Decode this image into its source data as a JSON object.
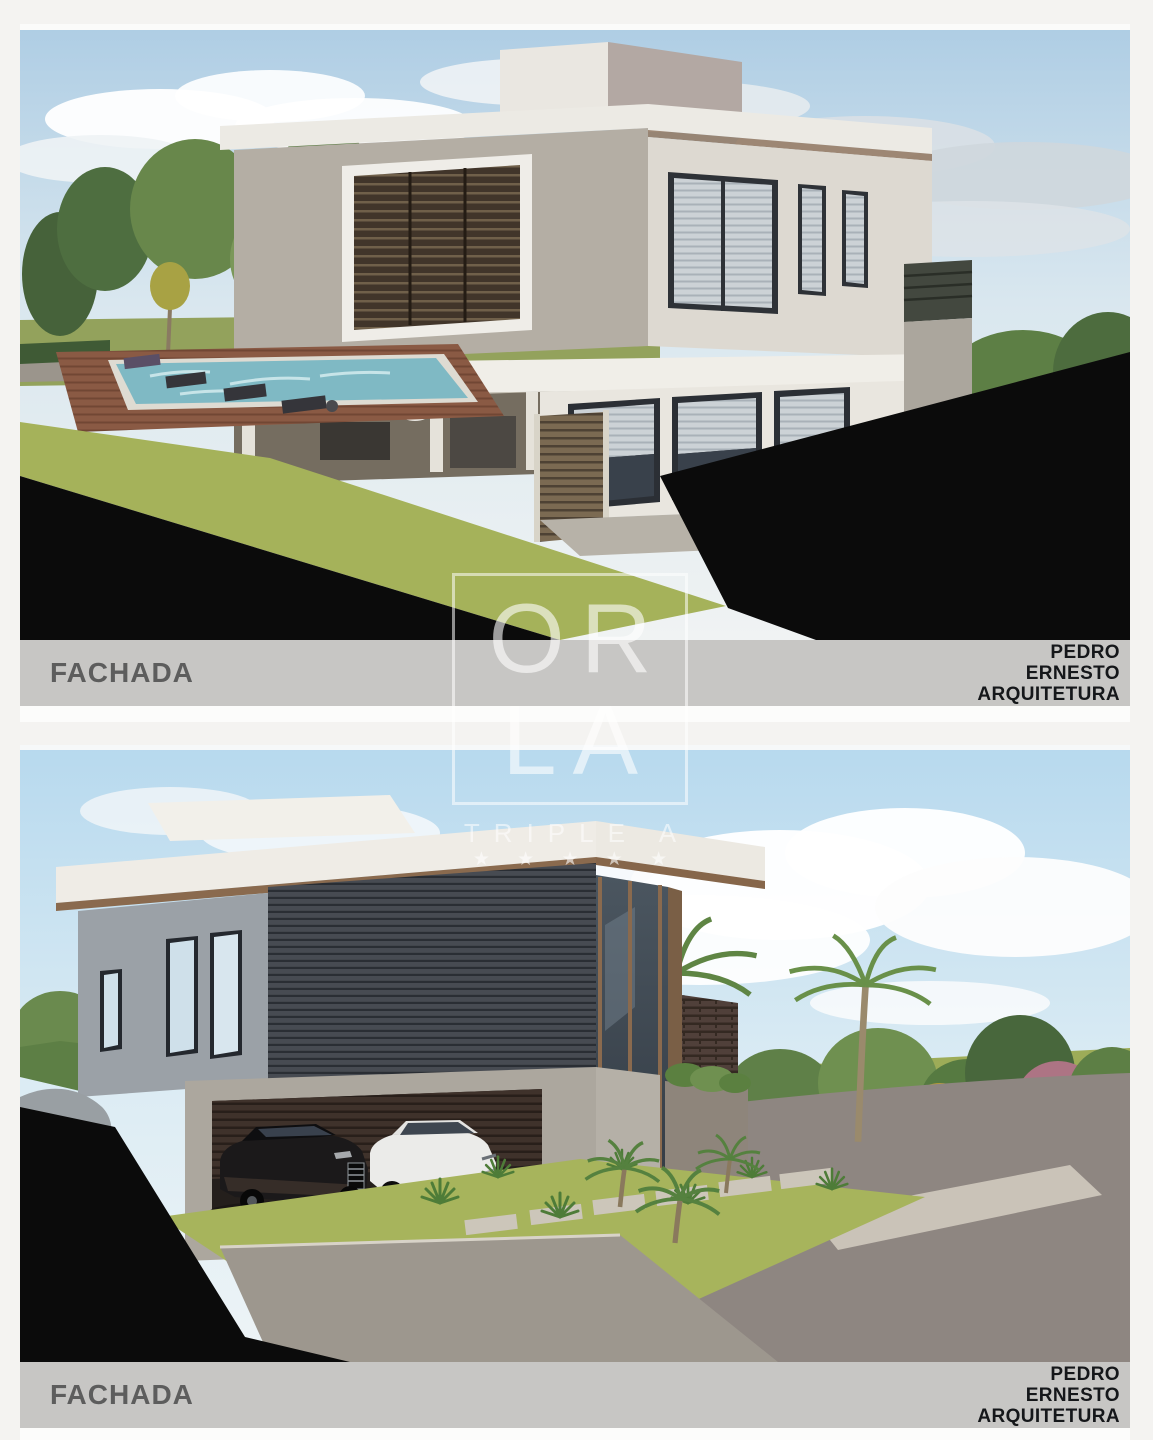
{
  "watermark": {
    "line1": "OR",
    "line2": "LA",
    "subtitle": "TRIPLE A",
    "stars": "★ ★ ★ ★ ★"
  },
  "panels": [
    {
      "caption": "FACHADA",
      "brand_lines": [
        "PEDRO",
        "ERNESTO",
        "ARQUITETURA"
      ]
    },
    {
      "caption": "FACHADA",
      "brand_lines": [
        "PEDRO",
        "ERNESTO",
        "ARQUITETURA"
      ]
    }
  ],
  "palette": {
    "page_background": "#f4f3f1",
    "caption_bar": "#c7c6c4",
    "caption_text": "#5d5d5d",
    "brand_text": "#15171a",
    "crop_mask_black": "#0b0b0b",
    "lawn_green": "#a5b25a",
    "pool_blue": "#7fb9c4",
    "deck_brown": "#8a5a44",
    "concrete_gray": "#b4aea4",
    "sky_blue_top_panel": "#aecde4",
    "sky_blue_bottom_panel": "#b7d9ee",
    "watermark_white": "rgba(255,255,255,0.55)"
  }
}
